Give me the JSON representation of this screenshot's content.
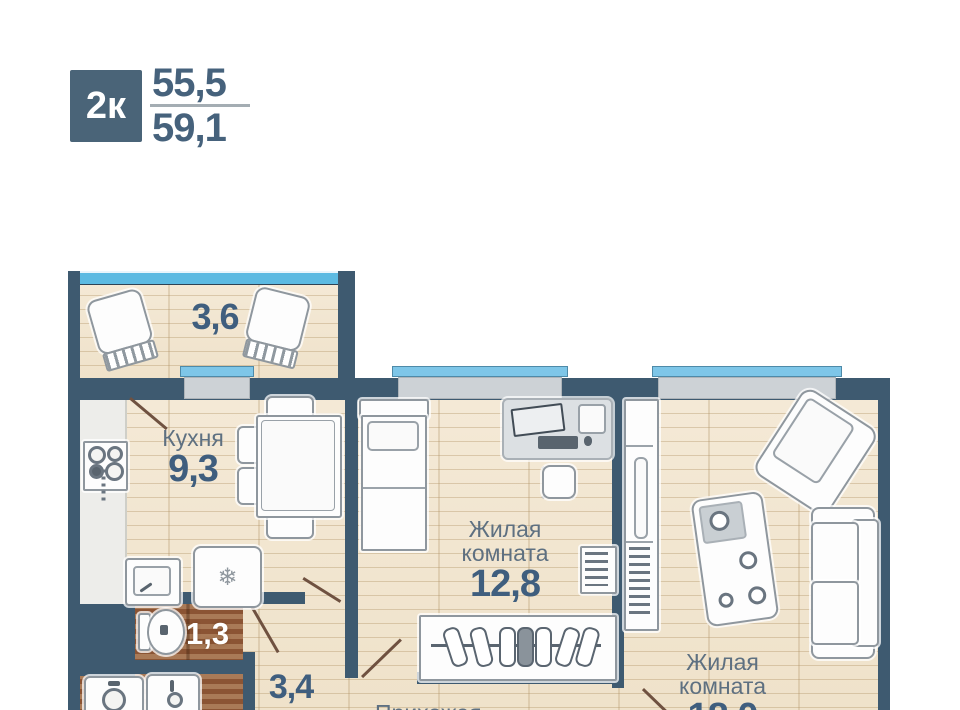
{
  "header": {
    "type_badge": "2к",
    "area_top": "55,5",
    "area_bottom": "59,1"
  },
  "rooms": {
    "balcony": {
      "area": "3,6"
    },
    "kitchen": {
      "name": "Кухня",
      "area": "9,3"
    },
    "living1": {
      "name_line1": "Жилая",
      "name_line2": "комната",
      "area": "12,8"
    },
    "living2": {
      "name_line1": "Жилая",
      "name_line2": "комната",
      "area": "18,0"
    },
    "wc": {
      "area": "1,3"
    },
    "hall": {
      "area": "3,4"
    },
    "entry": {
      "name": "Прихожая"
    }
  },
  "icons": {
    "snowflake": "❄"
  },
  "colors": {
    "wall": "#3E5A70",
    "badge": "#4A6478",
    "label_text": "#5E7081",
    "number_text": "#3F5E7E",
    "balcony_glazing": "#5CBAE2",
    "window_sill_blue": "#7EC6E8",
    "window_sill_gray": "#CDD2D6",
    "wood_floor": "#F2E7D3",
    "tile_floor": "#96603E",
    "door_swing": "#6F5140"
  }
}
